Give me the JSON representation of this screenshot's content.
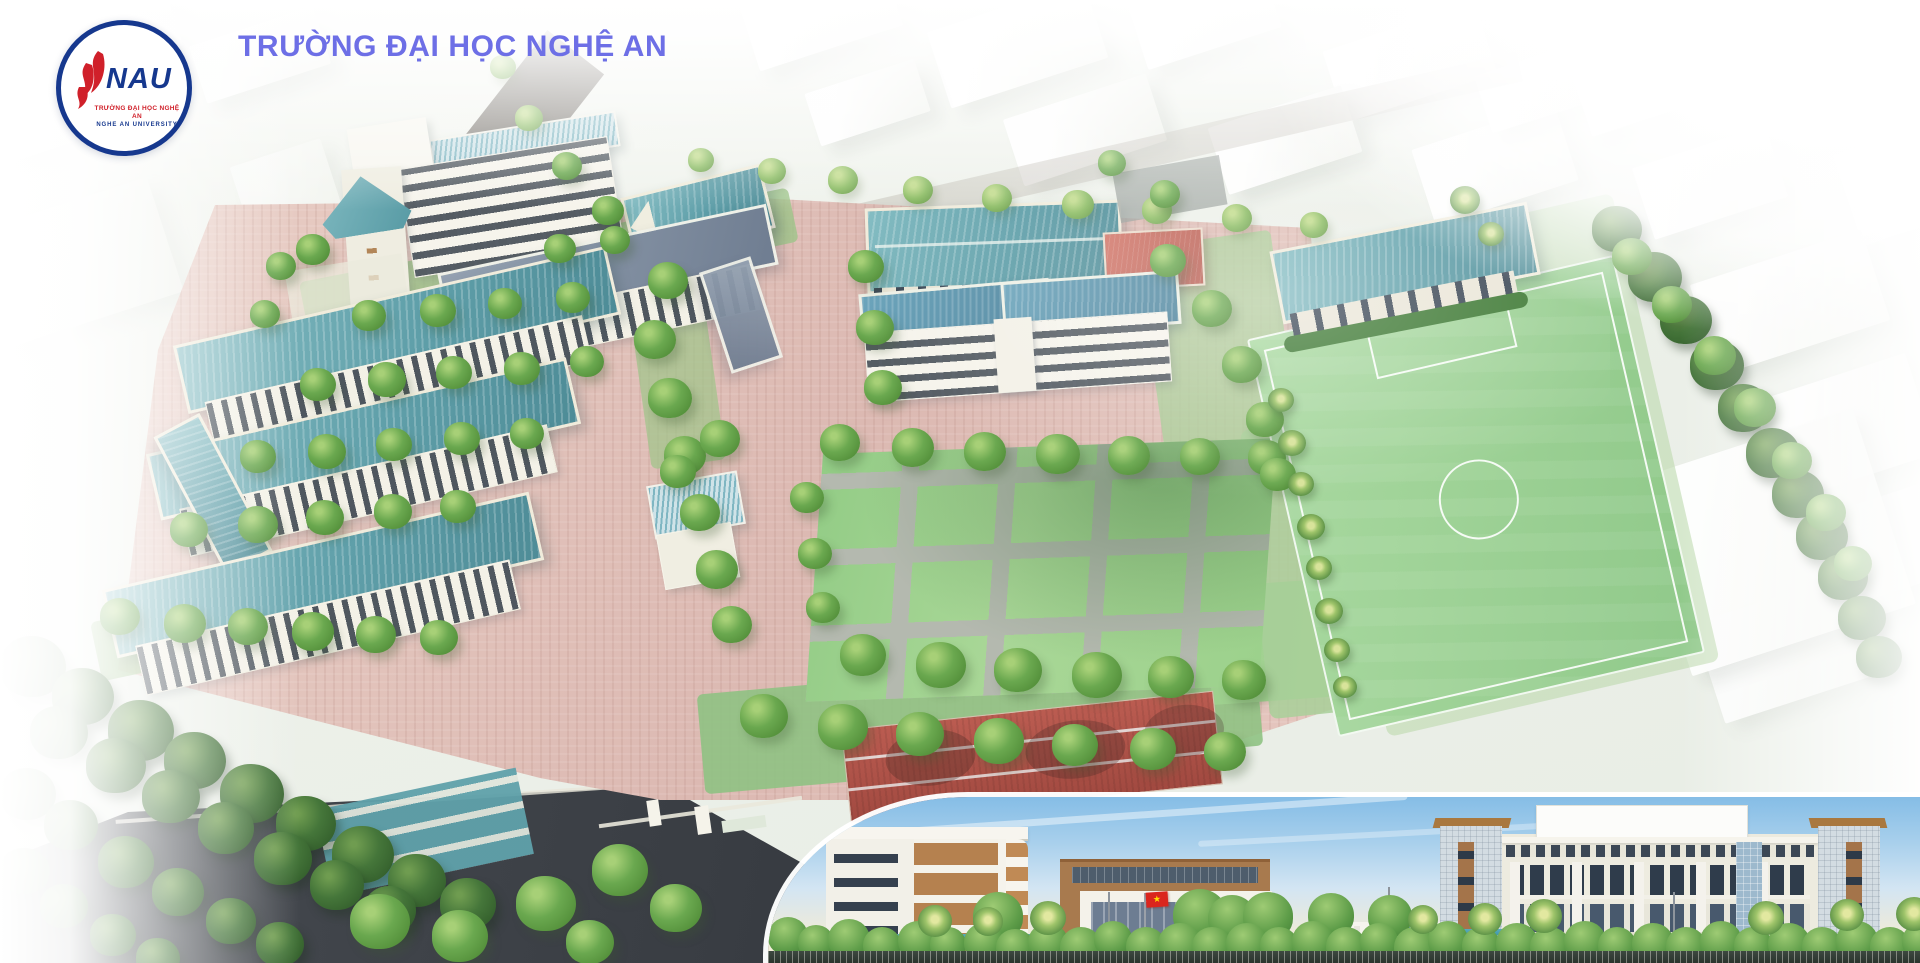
{
  "header": {
    "title": "TRƯỜNG ĐẠI HỌC NGHỆ AN"
  },
  "logo": {
    "abbr": "NAU",
    "line1": "TRƯỜNG ĐẠI HỌC NGHỆ AN",
    "line2": "NGHE AN UNIVERSITY"
  },
  "elevation": {
    "gate_sign": "TRƯỜNG ĐẠI HỌC KINH TẾ NGHỆ AN",
    "flag_icon": "vietnam-flag",
    "flag_star_glyph": "★"
  },
  "icons": {
    "logo_flame": "flame-petals-icon"
  },
  "colors": {
    "title": "#6d6fe6",
    "logo_blue": "#16388e",
    "logo_red": "#d0202a",
    "roof_teal": "#5f9fa9",
    "roof_slate": "#7c8a9c",
    "roof_blue": "#47809a",
    "roof_red": "#bb5c51",
    "pavement_pink": "#e3c6be",
    "lawn_green": "#a0d291",
    "path_gray": "#b4b9af",
    "field_green": "#9dd197",
    "tree_green": "#5a9a44",
    "asphalt_dark": "#3c4046",
    "sky_blue": "#85bde6",
    "sky_horizon": "#f8f1db",
    "flag_red": "#da251d",
    "flag_star_yellow": "#ffde00"
  }
}
